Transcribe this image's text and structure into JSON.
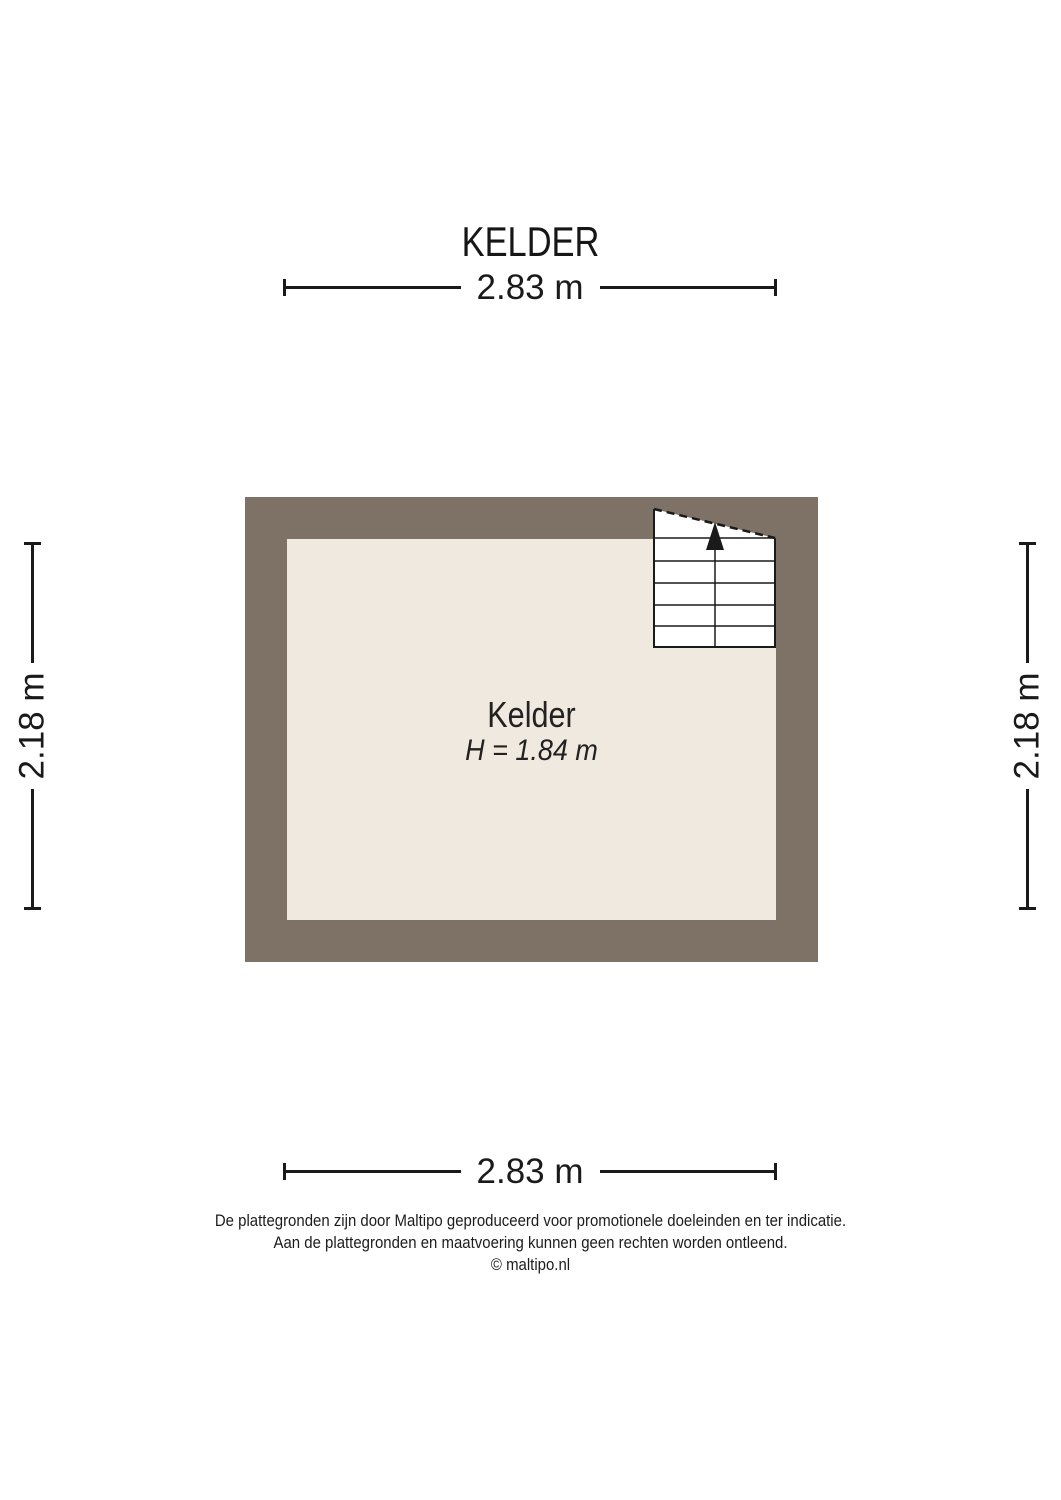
{
  "page": {
    "title": "KELDER"
  },
  "plan": {
    "room": {
      "name": "Kelder",
      "height": "H = 1.84 m"
    },
    "dimensions": {
      "width_top": "2.83 m",
      "width_bottom": "2.83 m",
      "height_left": "2.18 m",
      "height_right": "2.18 m"
    },
    "icons": {
      "stairs": "stairs-up-arrow"
    }
  },
  "footer": {
    "line1": "De plattegronden zijn door Maltipo geproduceerd voor promotionele doeleinden en ter indicatie.",
    "line2": "Aan de plattegronden en maatvoering kunnen geen rechten worden ontleend.",
    "line3": "© maltipo.nl"
  },
  "colors": {
    "wall": "#7e7267",
    "floor": "#f0e9df",
    "line": "#1a1a1a",
    "background": "#ffffff"
  }
}
